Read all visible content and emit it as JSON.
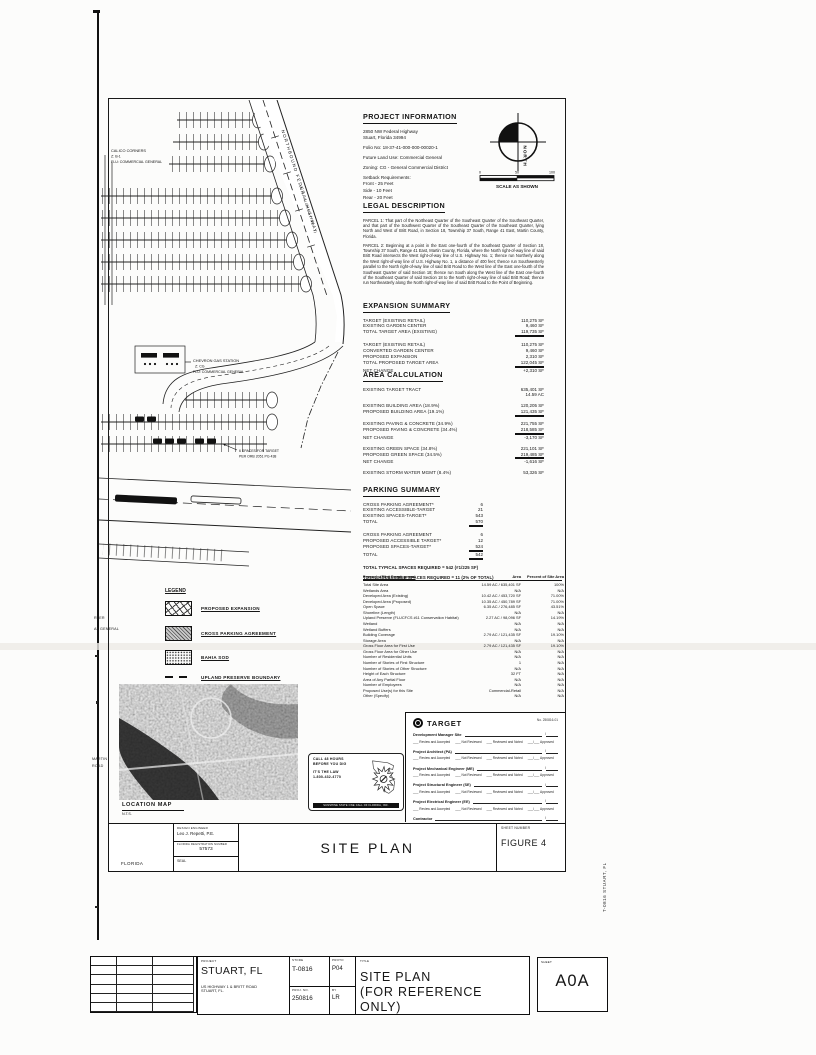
{
  "project_information": {
    "heading": "PROJECT INFORMATION",
    "address1": "2850 NW Federal Highway",
    "address2": "Stuart, Florida 34994",
    "folio": "Folio No: 18-37-41-000-000-00020-1",
    "land_use": "Future Land Use: Commercial General",
    "zoning": "Zoning: CG - General Commercial District",
    "setbacks_heading": "Setback Requirements:",
    "setbacks": [
      "Front - 25 Feet",
      "Side - 10 Feet",
      "Rear - 20 Feet"
    ]
  },
  "north": {
    "label": "NORTH",
    "ticks": [
      "0",
      "50",
      "100"
    ],
    "caption": "SCALE AS SHOWN"
  },
  "legal_description": {
    "heading": "LEGAL DESCRIPTION",
    "parcel1": "PARCEL 1:  That part of the Northeast Quarter of the Southeast Quarter of the Southeast Quarter, and that part of the Southwest Quarter of the Southeast Quarter of the Southeast Quarter, lying North and West of Britt Road, in Section 18, Township 37 South, Range 41 East, Martin County, Florida.",
    "parcel2": "PARCEL 2:  Beginning at a point in the East one-fourth of the Southeast Quarter of Section 18, Township 37 South, Range 41 East, Martin County, Florida, where the North right-of-way line of said Britt Road intersects the West right-of-way line of U.S. Highway No. 1; thence run Northerly along the West right-of-way line of U.S. Highway No. 1, a distance of 400 feet; thence run Southwesterly parallel to the North right-of-way line of said Britt Road to the West line of the East one-fourth of the Southeast Quarter of said Section 18; thence run South along the West line of the East one-fourth of the Southeast Quarter of said Section 18 to the North right-of-way line of said Britt Road; thence run Northeasterly along the North right-of-way line of said Britt Road to the Point of Beginning."
  },
  "expansion_summary": {
    "heading": "EXPANSION SUMMARY",
    "groups": [
      [
        {
          "l": "TARGET (EXISTING RETAIL)",
          "v": "110,275 SF"
        },
        {
          "l": "EXISTING GARDEN CENTER",
          "v": "9,460 SF"
        },
        {
          "l": "TOTAL TARGET AREA (EXISTING)",
          "v": "119,735 SF",
          "t": true
        }
      ],
      [
        {
          "l": "TARGET (EXISTING RETAIL)",
          "v": "110,275 SF"
        },
        {
          "l": "CONVERTED GARDEN CENTER",
          "v": "9,460 SF"
        },
        {
          "l": "PROPOSED EXPANSION",
          "v": "2,310 SF"
        },
        {
          "l": "TOTAL PROPOSED TARGET AREA",
          "v": "122,045 SF",
          "t": true
        },
        {
          "l": "NET CHANGE",
          "v": "+2,310 SF"
        }
      ]
    ]
  },
  "area_calculation": {
    "heading": "AREA CALCULATION",
    "groups": [
      [
        {
          "l": "EXISTING TARGET TRACT",
          "v": "635,401 SF"
        },
        {
          "l": "",
          "v": "14.59 AC"
        }
      ],
      [
        {
          "l": "EXISTING BUILDING AREA (18.9%)",
          "v": "120,205 SF"
        },
        {
          "l": "PROPOSED BUILDING AREA (19.1%)",
          "v": "121,435 SF",
          "t": true
        }
      ],
      [
        {
          "l": "EXISTING PAVING & CONCRETE (34.9%)",
          "v": "221,755 SF"
        },
        {
          "l": "PROPOSED PAVING & CONCRETE (34.4%)",
          "v": "218,585 SF",
          "t": true
        },
        {
          "l": "NET CHANGE",
          "v": "-3,170 SF"
        }
      ],
      [
        {
          "l": "EXISTING GREEN SPACE (34.8%)",
          "v": "221,101 SF"
        },
        {
          "l": "PROPOSED GREEN SPACE (34.5%)",
          "v": "219,485 SF",
          "t": true
        },
        {
          "l": "NET CHANGE",
          "v": "-1,616 SF"
        }
      ],
      [
        {
          "l": "EXISTING STORM WATER MGMT (8.4%)",
          "v": "53,326 SF"
        }
      ]
    ]
  },
  "parking_summary": {
    "heading": "PARKING SUMMARY",
    "groups": [
      [
        {
          "l": "CROSS PARKING AGREEMENT*",
          "v": "6"
        },
        {
          "l": "EXISTING ACCESSIBLE-TARGET",
          "v": "21"
        },
        {
          "l": "EXISTING SPACES-TARGET*",
          "v": "543"
        },
        {
          "l": "TOTAL",
          "v": "570",
          "t": true
        }
      ],
      [
        {
          "l": "CROSS PARKING AGREEMENT",
          "v": "6"
        },
        {
          "l": "PROPOSED ACCESSIBLE TARGET*",
          "v": "12"
        },
        {
          "l": "PROPOSED SPACES-TARGET*",
          "v": "524",
          "t": true
        },
        {
          "l": "TOTAL",
          "v": "542",
          "t": true
        }
      ]
    ],
    "notes": [
      "TOTAL TYPICAL SPACES REQUIRED = 542 (#1/225 SF)",
      "TOTAL ACCESSIBLE SPACES REQUIRED = 11 (2% OF TOTAL)"
    ]
  },
  "development_table": {
    "header": {
      "c1": "Property (Site) Development",
      "c2": "Area",
      "c3": "Percent of Site Area"
    },
    "rows": [
      {
        "l": "Total Site Area",
        "a": "14.59 AC / 635,401 SF",
        "p": "100%"
      },
      {
        "l": "Wetlands Area",
        "a": "N/A",
        "p": "N/A"
      },
      {
        "l": "Developed Area (Existing)",
        "a": "10.42 AC / 453,720 SF",
        "p": "71.00%"
      },
      {
        "l": "Developed Area (Proposed)",
        "a": "10.35 AC / 450,789 SF",
        "p": "71.00%"
      },
      {
        "l": "Open Space",
        "a": "6.35 AC / 276,485 SF",
        "p": "43.51%"
      },
      {
        "l": "Shoreline (Length)",
        "a": "N/A",
        "p": "N/A"
      },
      {
        "l": "Upland Preserve (FLUCFCS #11 Conservation Habitat)",
        "a": "2.27 AC / 98,096 SF",
        "p": "14.19%"
      },
      {
        "l": "Wetland",
        "a": "N/A",
        "p": "N/A"
      },
      {
        "l": "Wetland Buffers",
        "a": "N/A",
        "p": "N/A"
      },
      {
        "l": "Building Coverage",
        "a": "2.79 AC / 121,435 SF",
        "p": "19.10%"
      },
      {
        "l": "Storage Area",
        "a": "N/A",
        "p": "N/A"
      },
      {
        "l": "Gross Floor Area for First Use",
        "a": "2.79 AC / 121,435 SF",
        "p": "19.10%"
      },
      {
        "l": "Gross Floor Area for Other Use",
        "a": "N/A",
        "p": "N/A"
      },
      {
        "l": "Number of Residential Units",
        "a": "N/A",
        "p": "N/A"
      },
      {
        "l": "Number of Stories of First Structure",
        "a": "1",
        "p": "N/A"
      },
      {
        "l": "Number of Stories of Other Structure",
        "a": "N/A",
        "p": "N/A"
      },
      {
        "l": "Height of Each Structure",
        "a": "32 FT",
        "p": "N/A"
      },
      {
        "l": "Area of Any Partial Floor",
        "a": "N/A",
        "p": "N/A"
      },
      {
        "l": "Number of Employees",
        "a": "N/A",
        "p": "N/A"
      },
      {
        "l": "Proposed Use(s) for this Site",
        "a": "Commercial-Retail",
        "p": "N/A"
      },
      {
        "l": "Other (Specify)",
        "a": "N/A",
        "p": "N/A"
      }
    ]
  },
  "target_block": {
    "brand": "TARGET",
    "ref": "No. 250816-01",
    "roles": [
      "Development Manager Site",
      "Project Architect (PA)",
      "Project Mechanical Engineer (ME)",
      "Project Structural Engineer (SE)",
      "Project Electrical Engineer (EE)",
      "Contractor"
    ],
    "options": [
      "Review and Accepted",
      "Not Reviewed",
      "Reviewed and Noted",
      "Approved"
    ],
    "note": "Approval is for the review and notes of the Site Construction by Target Developer/Build teams, Section 2.2 and the Target building documents. Compliance with and adherence to the Site Construction documents remains with the Site Civil Engineer and developer of record per the Site Construction Documents."
  },
  "legend": {
    "heading": "LEGEND",
    "items": [
      {
        "type": "crosshatch",
        "label": "PROPOSED EXPANSION"
      },
      {
        "type": "diagonal",
        "label": "CROSS PARKING AGREEMENT"
      },
      {
        "type": "stipple",
        "label": "BAHIA SOD"
      },
      {
        "type": "dashline",
        "label": "UPLAND PRESERVE BOUNDARY"
      }
    ]
  },
  "location_map": {
    "label": "LOCATION MAP",
    "scale": "N.T.S."
  },
  "dig_stamp": {
    "line1": "CALL 48 HOURS",
    "line2": "BEFORE YOU DIG",
    "line3": "IT'S THE LAW",
    "line4": "1-800-432-4770",
    "footer": "SUNSHINE STATE ONE CALL OF FLORIDA, INC."
  },
  "site_plan": {
    "calico": [
      "CALICO CORNERS",
      "Z: B-1",
      "FLU: COMMERCIAL GENERAL"
    ],
    "chevron": [
      "CHEVRON GAS STATION",
      "Z: CG",
      "FLU: COMMERCIAL GENERAL"
    ],
    "target_spaces": [
      "6 SPACES FOR TARGET",
      "PER ORB 2051 PG 438"
    ],
    "highway_label": "NORTHBOUND FEDERAL HIGHWAY",
    "highway_sub": "(U.S. HIGHWAY NO. 1)",
    "cut_top1": "RTER",
    "cut_top2": "AL GENERAL",
    "cut_bot1": "MARTIN",
    "cut_bot2": "ROAD"
  },
  "title_block": {
    "engineer_label": "DESIGN ENGINEER",
    "engineer": "Leo J. Repetti, P.E.",
    "reg_label": "FLORIDA REGISTRATION NUMBER",
    "reg_number": "57573",
    "state": "FLORIDA",
    "seal": "SEAL",
    "title": "SITE PLAN",
    "sheet_label": "SHEET NUMBER",
    "sheet": "FIGURE 4"
  },
  "bottom_block": {
    "labels": {
      "project": "PROJECT",
      "store": "STORE",
      "proto": "PROTO",
      "proj_no": "PROJ. NO.",
      "by": "BY",
      "title": "TITLE",
      "sheet": "SHEET"
    },
    "project_city": "STUART, FL",
    "address1": "US HIGHWAY 1 & BRITT ROAD",
    "address2": "STUART, FL.",
    "store_no": "T-0816",
    "proto": "P04",
    "proj_no": "250816",
    "by": "LR",
    "title1": "SITE PLAN",
    "title2": "(FOR REFERENCE ONLY)",
    "sheet": "A0A"
  },
  "side_text": "T-0816    STUART, FL"
}
